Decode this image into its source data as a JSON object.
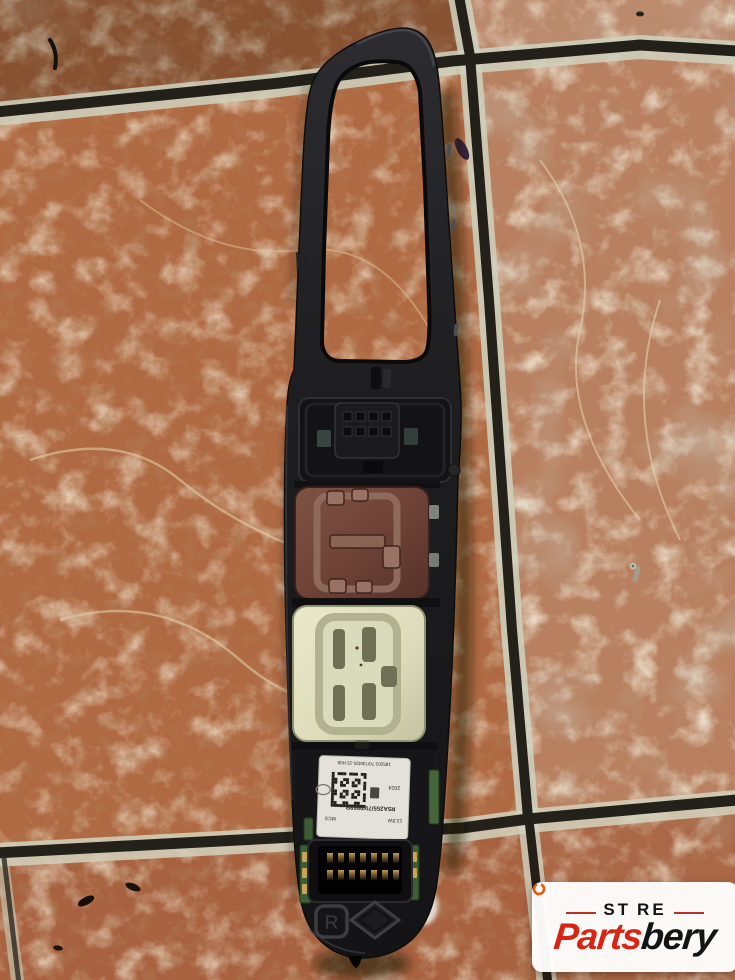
{
  "part_label": {
    "top_line": "185203 70/74M25-15 H08",
    "year": "2024",
    "part_number": "R5A255/70/9868R",
    "maker_code": "MCS",
    "rating": "13.5W"
  },
  "emblems": {
    "letter_mark": "R",
    "diamond_icon": "renault-diamond-icon"
  },
  "watermark": {
    "store_left": "ST",
    "store_right": "RE",
    "store_word": "STORE",
    "brand_red": "Parts",
    "brand_black": "bery",
    "accent_red": "#d92313",
    "ring_orange": "#e8550f"
  },
  "colors": {
    "tile_base": "#b06a43",
    "tile_vein": "#ddc9a4",
    "tile_spot": "#6b3116",
    "grout_dark": "#23201a",
    "grout_light": "#cfd2c0",
    "part_black": "#1d1d20",
    "module_brown": "#714439",
    "module_cream": "#e2e1c0",
    "pcb_green": "#3f6136",
    "pin_gold": "#c39d52",
    "label_white": "#e4e1da"
  }
}
